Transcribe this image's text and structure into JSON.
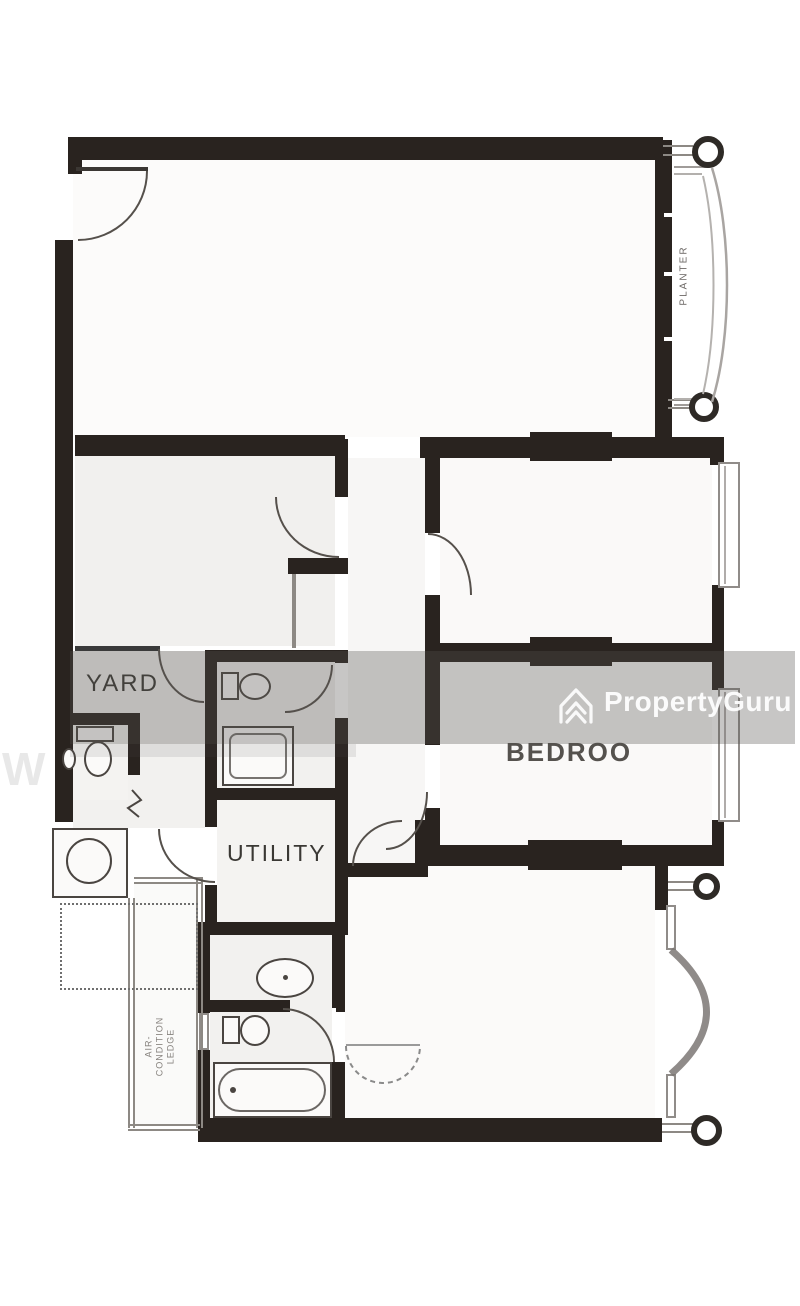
{
  "meta": {
    "kind": "property floor plan image",
    "width_px": 800,
    "height_px": 1306
  },
  "watermark": {
    "brand": "PropertyGuru",
    "icon": "propertyguru-chevron-icon",
    "band_color": "#555250",
    "band_opacity": 0.33,
    "brand_text_color": "#ffffff",
    "partial_left_text": "W"
  },
  "labels": {
    "planter": "PLANTER",
    "yard": "YARD",
    "utility": "UTILITY",
    "bedroom_partial": "BEDROO",
    "aircon_line1": "AIR-",
    "aircon_line2": "CONDITION",
    "aircon_line3": "LEDGE"
  },
  "colors": {
    "wall": "#29231f",
    "thin_line": "#8d8984",
    "fixture_outline": "#4a4541",
    "floor_tint": "#f2f1ef",
    "background": "#ffffff"
  },
  "fixtures": [
    "entrance-door-arc",
    "planter-with-columns",
    "bedroom-windows",
    "bay-window",
    "wc-toilet",
    "bathroom-toilet",
    "shower-tray",
    "master-bath-sink",
    "master-bath-toilet",
    "bathtub",
    "washing-machine",
    "dashed-wardrobe-arc",
    "yard-dotted-lines",
    "round-columns"
  ]
}
